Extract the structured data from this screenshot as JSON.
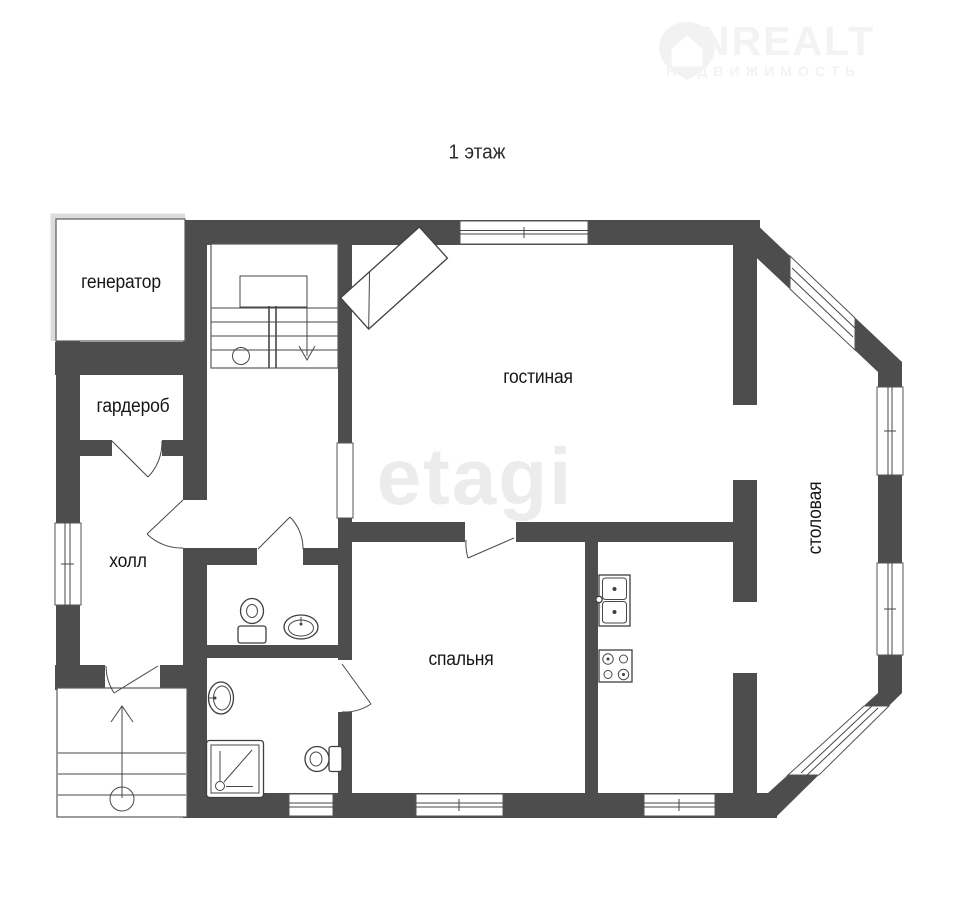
{
  "title": "1 этаж",
  "watermarks": {
    "etagi": "etagi",
    "onrealt": {
      "title": "ONREALT",
      "subtitle": "НЕДВИЖИМОСТЬ"
    }
  },
  "rooms": {
    "generator": "генератор",
    "wardrobe": "гардероб",
    "hall": "холл",
    "living": "гостиная",
    "bedroom": "спальня",
    "dining": "столовая"
  },
  "icons": {
    "logo_pin": "house-location-pin",
    "fixtures": [
      "toilet-icon",
      "sink-icon",
      "shower-icon",
      "kitchen-sink-icon",
      "stove-icon",
      "fireplace-icon",
      "staircase-icon",
      "entry-stairs-icon"
    ]
  },
  "colors": {
    "wall": "#4d4d4d",
    "line": "#474747",
    "text": "#161616",
    "watermark_etagi": "#ececec",
    "watermark_onrealt": "#f3f3f3"
  }
}
